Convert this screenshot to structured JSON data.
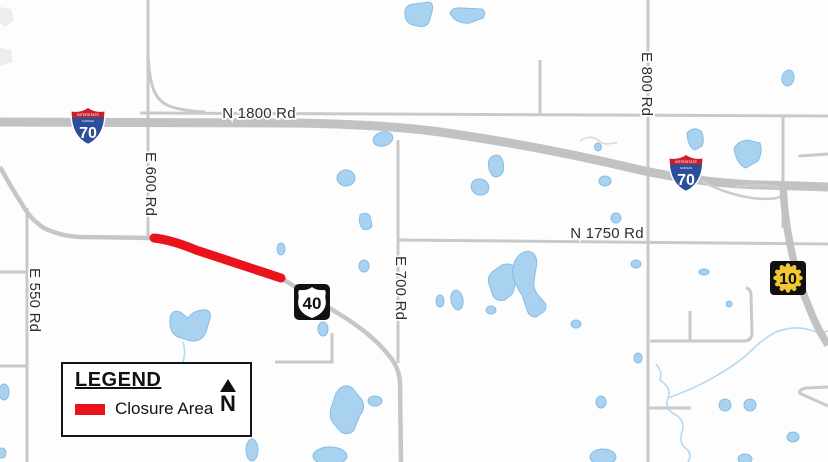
{
  "map": {
    "road_labels": {
      "n1800": "N 1800 Rd",
      "n1750": "N 1750 Rd",
      "e550": "E 550 Rd",
      "e600": "E 600 Rd",
      "e700": "E 700 Rd",
      "e800": "E 800 Rd"
    },
    "shields": {
      "interstate_banner": "INTERSTATE",
      "interstate_state": "KANSAS",
      "i70_number": "70",
      "us40_number": "40",
      "k10_number": "10"
    },
    "colors": {
      "background": "#fdfdfd",
      "road_gray": "#c9c9c9",
      "highway_gray": "#c2c2c2",
      "water_fill": "#a9d2f0",
      "water_stroke": "#86bde6",
      "closure_red": "#e8131b",
      "interstate_blue": "#2b4d9b",
      "interstate_red": "#c8202e",
      "sunflower_yellow": "#f3c633",
      "shield_black": "#111111"
    }
  },
  "legend": {
    "title": "LEGEND",
    "closure_label": "Closure Area",
    "north_label": "N"
  }
}
